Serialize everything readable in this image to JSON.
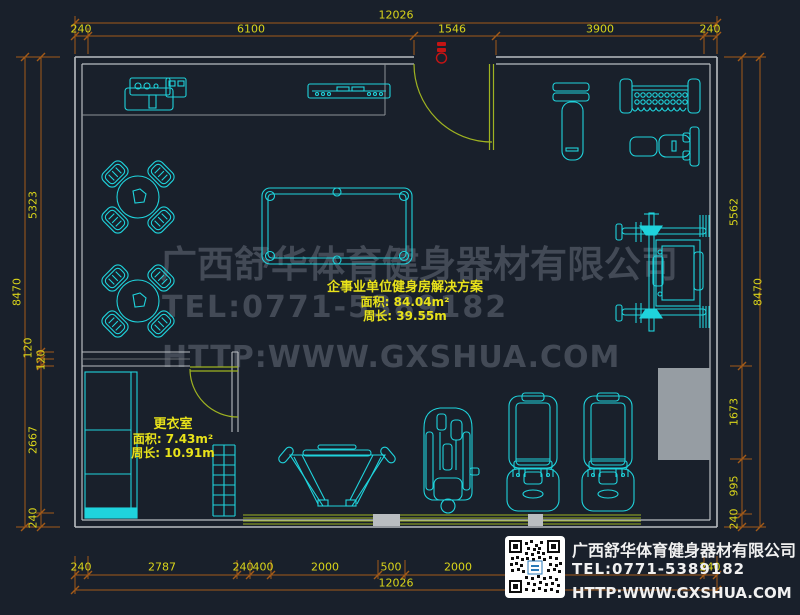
{
  "drawing": {
    "type": "gym floor plan (CAD top view)",
    "plan_label": {
      "title": "企事业单位健身房解决方案",
      "area": "面积: 84.04m²",
      "perimeter": "周长: 39.55m"
    },
    "changing_room_label": {
      "title": "更衣室",
      "area": "面积: 7.43m²",
      "perimeter": "周长: 10.91m"
    }
  },
  "watermark": {
    "company": "广西舒华体育健身器材有限公司",
    "tel": "TEL:0771-5389182",
    "url": "HTTP:WWW.GXSHUA.COM"
  },
  "contact_card": {
    "qr_icon": "qr-code",
    "company": "广西舒华体育健身器材有限公司",
    "tel": "TEL:0771-5389182",
    "url": "HTTP:WWW.GXSHUA.COM"
  },
  "dimensions": {
    "top": {
      "overall": "12026",
      "chain": [
        "240",
        "6100",
        "1546",
        "3900",
        "240"
      ]
    },
    "bottom": {
      "overall": "12026",
      "chain": [
        "240",
        "2787",
        "240",
        "400",
        "2000",
        "500",
        "2000",
        "240"
      ]
    },
    "left": {
      "overall": "8470",
      "chain": [
        "5323",
        "120",
        "120",
        "2667",
        "240"
      ]
    },
    "right": {
      "overall": "8470",
      "chain": [
        "5562",
        "1673",
        "995",
        "240"
      ]
    }
  },
  "colors": {
    "background": "#19202b",
    "equipment": "#1fd3dc",
    "walls": "#b9bdc1",
    "dimension_line": "#a35a18",
    "dimension_text": "#d9d41a",
    "door_window": "#9fb321",
    "label_text": "#e8e21a",
    "watermark": "#828a98",
    "entry_marker": "#c41414",
    "contact_text": "#f1f1f1"
  }
}
